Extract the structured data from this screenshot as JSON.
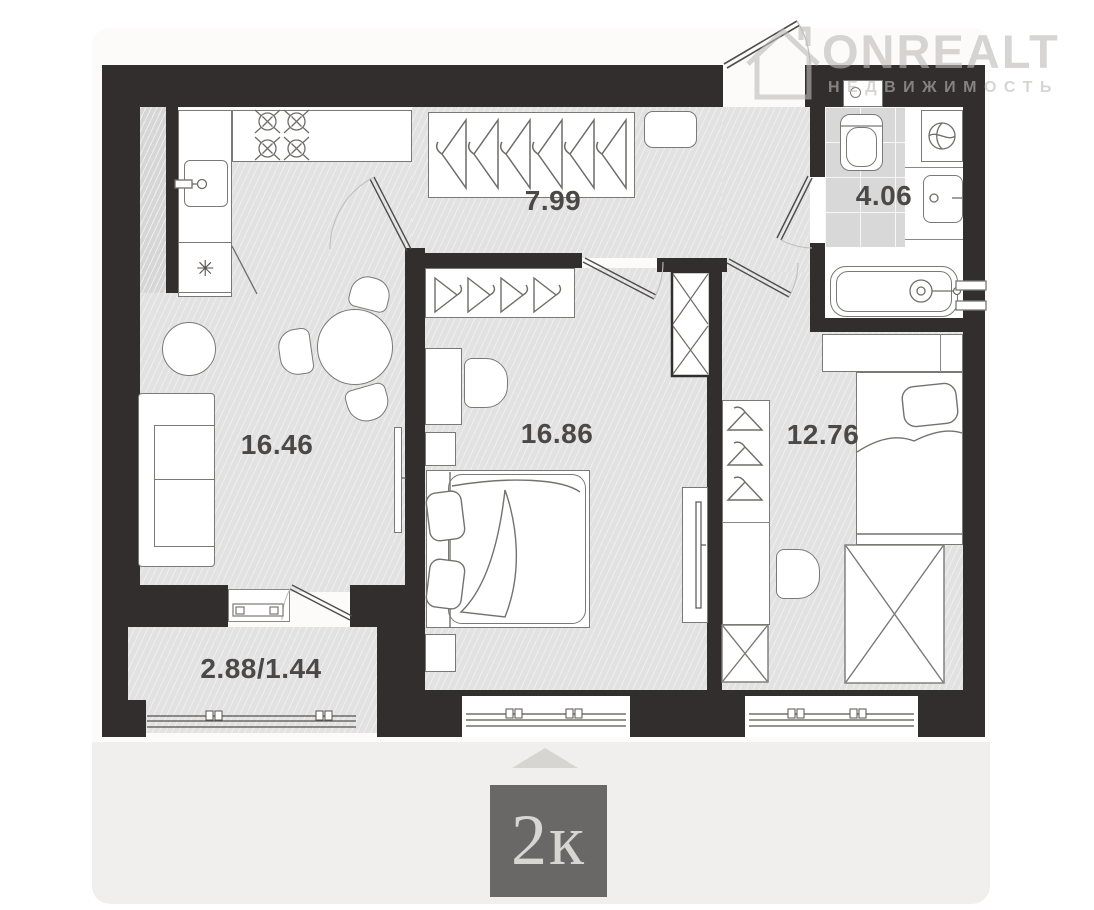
{
  "watermark": {
    "brand": "ONREALT",
    "subtitle": "НЕДВИЖИМОСТЬ"
  },
  "rooms": [
    {
      "name": "hallway",
      "area": "7.99"
    },
    {
      "name": "bathroom",
      "area": "4.06"
    },
    {
      "name": "kitchen-living-room",
      "area": "16.46"
    },
    {
      "name": "bedroom",
      "area": "16.86"
    },
    {
      "name": "bedroom-2",
      "area": "12.76"
    },
    {
      "name": "balcony",
      "area": "2.88/1.44"
    }
  ],
  "badge": {
    "label": "2к"
  },
  "icons": {
    "fridge_snowflake": "✳"
  },
  "colors": {
    "wall": "#312e2d",
    "floor": "#e2e2e3",
    "tile": "#d8d8d9",
    "card": "#f1efed",
    "plan_bg": "#fcfbfa",
    "label": "#4b4947",
    "badge_bg": "#6a6866",
    "badge_text": "#d8d6d2",
    "watermark": "#bdbab7"
  }
}
